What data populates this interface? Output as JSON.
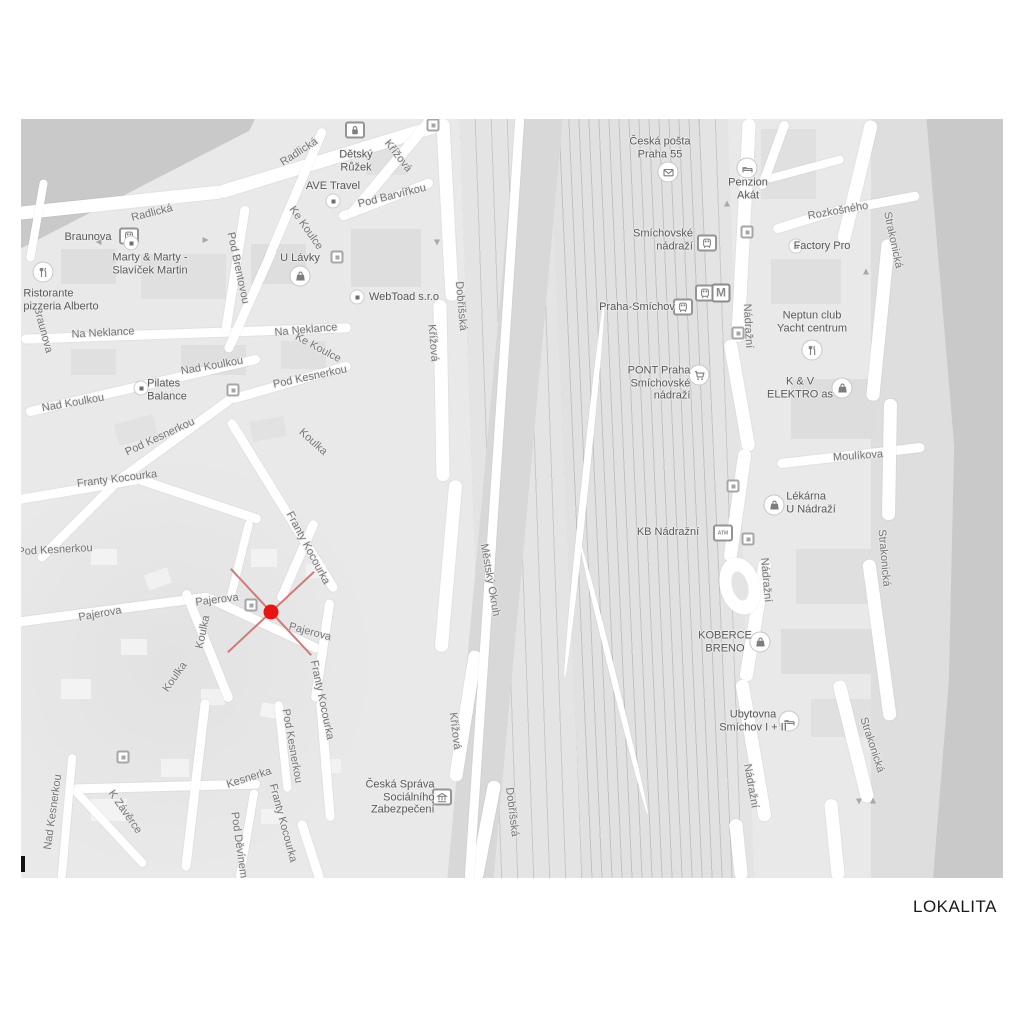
{
  "caption": "LOKALITA",
  "marker": {
    "type": "location-cross-marker",
    "color": "#e81313",
    "cross_color": "#cf7b7b"
  },
  "map": {
    "metro_label": "M",
    "streets": [
      "Radlická",
      "Radlická",
      "Braunova",
      "Na Neklance",
      "Na Neklance",
      "Nad Koulkou",
      "Nad Koulkou",
      "Pod Kesnerkou",
      "Pod Kesnerkou",
      "Pod Kesnerkou",
      "Pod Kesnerkou",
      "Koulka",
      "Koulka",
      "Koulka",
      "Franty Kocourka",
      "Franty Kocourka",
      "Franty Kocourka",
      "Franty Kocourka",
      "Pajerova",
      "Pajerova",
      "Pajerova",
      "Kesnerka",
      "Pod Děvínem",
      "K Závěrce",
      "Nad Kesnerkou",
      "Ke Koulce",
      "Ke Koulce",
      "Pod Brentovou",
      "Pod Barvířkou",
      "Křížová",
      "Křížová",
      "Křížová",
      "Dobříšská",
      "Dobříšská",
      "Městský Okruh",
      "Nádražní",
      "Nádražní",
      "Nádražní",
      "Strakonická",
      "Strakonická",
      "Strakonická",
      "Moulíkova",
      "Rozkošného"
    ],
    "pois": [
      {
        "icon": "lock",
        "lines": [
          "Dětský",
          "Růžek"
        ]
      },
      {
        "icon": "dot",
        "lines": [
          "AVE Travel"
        ]
      },
      {
        "icon": "tram",
        "lines": [
          "Braunova"
        ]
      },
      {
        "icon": "dot",
        "lines": [
          "Marty & Marty -",
          "Slavíček Martin"
        ]
      },
      {
        "icon": "restaurant",
        "lines": [
          "Ristorante",
          "pizzeria Alberto"
        ]
      },
      {
        "icon": "bag",
        "lines": [
          "U Lávky"
        ]
      },
      {
        "icon": "dot",
        "lines": [
          "WebToad s.r.o"
        ]
      },
      {
        "icon": "dot",
        "lines": [
          "Pilates",
          "Balance"
        ]
      },
      {
        "icon": "envelope",
        "lines": [
          "Česká pošta",
          "Praha 55"
        ]
      },
      {
        "icon": "train",
        "lines": [
          "Smíchovské",
          "nádraží"
        ]
      },
      {
        "icon": "train",
        "lines": [
          "Praha-Smíchov"
        ]
      },
      {
        "icon": "bed",
        "lines": [
          "Penzion",
          "Akát"
        ]
      },
      {
        "icon": "cart",
        "lines": [
          "PONT Praha",
          "Smíchovské",
          "nádraží"
        ]
      },
      {
        "icon": "bag",
        "lines": [
          "K & V",
          "ELEKTRO as"
        ]
      },
      {
        "icon": "dot",
        "lines": [
          "Factory Pro"
        ]
      },
      {
        "icon": "restaurant",
        "lines": [
          "Neptun club",
          "Yacht centrum"
        ]
      },
      {
        "icon": "bag",
        "lines": [
          "Lékárna",
          "U Nádraží"
        ]
      },
      {
        "icon": "atm",
        "lines": [
          "KB Nádražní"
        ]
      },
      {
        "icon": "bag",
        "lines": [
          "KOBERCE",
          "BRENO"
        ]
      },
      {
        "icon": "bed",
        "lines": [
          "Ubytovna",
          "Smíchov I + II"
        ]
      },
      {
        "icon": "bank",
        "lines": [
          "Česká Správa",
          "Sociálního",
          "Zabezpečení"
        ]
      }
    ]
  }
}
